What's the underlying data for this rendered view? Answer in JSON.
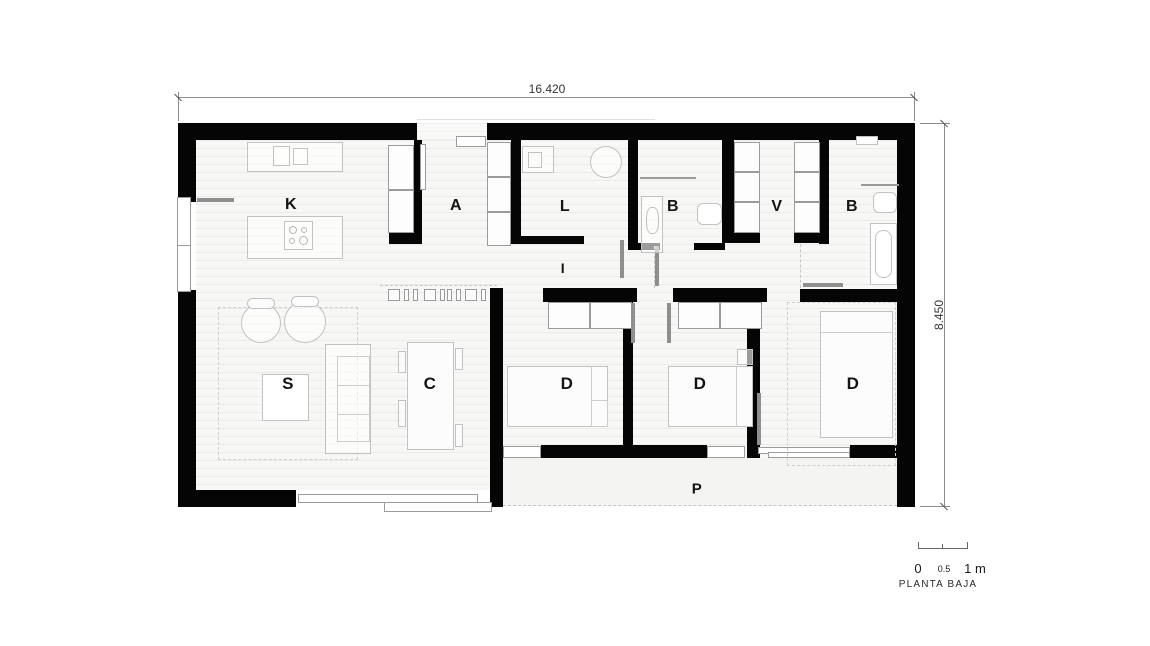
{
  "plan": {
    "caption": "PLANTA BAJA"
  },
  "dimensions": {
    "overall_width_m": "16.420",
    "overall_height_m": "8.450"
  },
  "scale_bar": {
    "zero": "0",
    "half": "0.5",
    "one": "1 m"
  },
  "rooms": {
    "kitchen": {
      "label": "K"
    },
    "entrance": {
      "label": "A"
    },
    "laundry": {
      "label": "L"
    },
    "bathroom1": {
      "label": "B"
    },
    "dressing": {
      "label": "V"
    },
    "bathroom2": {
      "label": "B"
    },
    "hallway": {
      "label": "I"
    },
    "living": {
      "label": "S"
    },
    "dining": {
      "label": "C"
    },
    "bedroom1": {
      "label": "D"
    },
    "bedroom2": {
      "label": "D"
    },
    "bedroom3": {
      "label": "D"
    },
    "porch": {
      "label": "P"
    }
  },
  "colors": {
    "wall": "#050505",
    "floor": "#f7f7f6",
    "floor_line": "#ebebea",
    "furniture_line": "#c2c2c2",
    "frame_line": "#9b9b9b",
    "dimension_line": "#8c8c8c",
    "text": "#141414"
  }
}
